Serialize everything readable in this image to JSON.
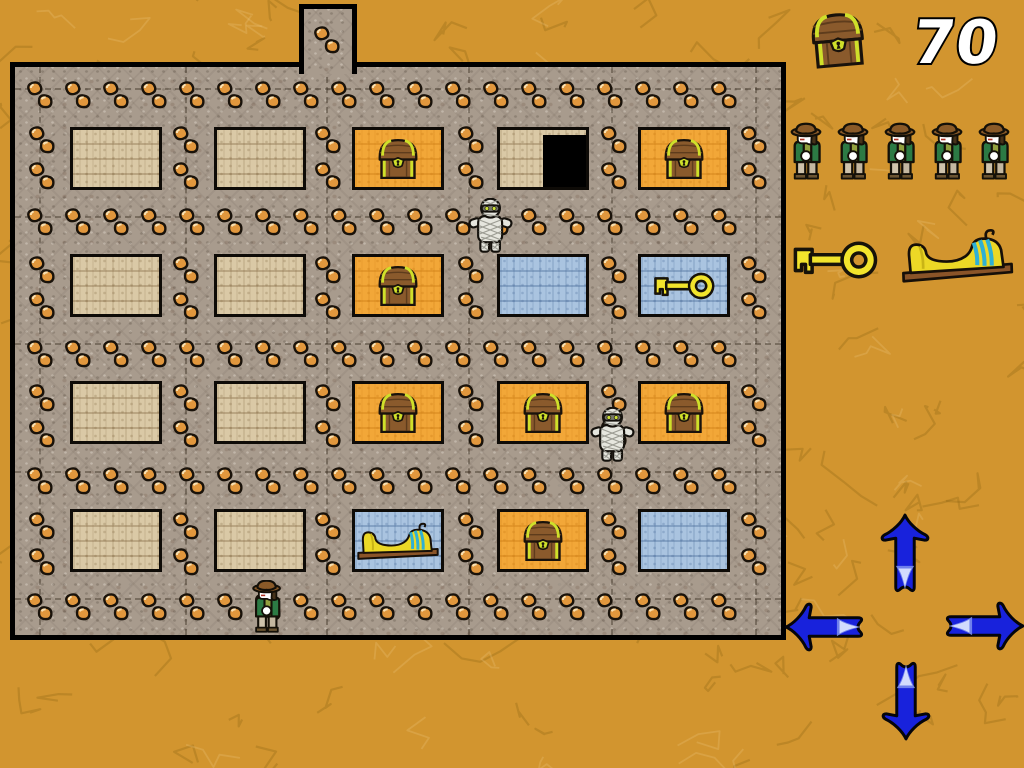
{
  "hud": {
    "score": {
      "value": "70",
      "icon": "treasure-chest-icon"
    },
    "lives": {
      "count": 5,
      "icon": "explorer-icon"
    },
    "goal_items": [
      {
        "icon": "key-icon"
      },
      {
        "icon": "sarcophagus-icon"
      }
    ]
  },
  "controls": {
    "buttons": [
      {
        "direction": "up",
        "icon": "up-arrow-icon"
      },
      {
        "direction": "left",
        "icon": "left-arrow-icon"
      },
      {
        "direction": "right",
        "icon": "right-arrow-icon"
      },
      {
        "direction": "down",
        "icon": "down-arrow-icon"
      }
    ]
  },
  "board": {
    "rows": 4,
    "cols": 5,
    "cells": [
      {
        "row": 0,
        "col": 0,
        "type": "tan",
        "item": null
      },
      {
        "row": 0,
        "col": 1,
        "type": "tan",
        "item": null
      },
      {
        "row": 0,
        "col": 2,
        "type": "orange",
        "item": "chest"
      },
      {
        "row": 0,
        "col": 3,
        "type": "tan",
        "item": "door"
      },
      {
        "row": 0,
        "col": 4,
        "type": "orange",
        "item": "chest"
      },
      {
        "row": 1,
        "col": 0,
        "type": "tan",
        "item": null
      },
      {
        "row": 1,
        "col": 1,
        "type": "tan",
        "item": null
      },
      {
        "row": 1,
        "col": 2,
        "type": "orange",
        "item": "chest"
      },
      {
        "row": 1,
        "col": 3,
        "type": "blue",
        "item": null
      },
      {
        "row": 1,
        "col": 4,
        "type": "blue",
        "item": "key"
      },
      {
        "row": 2,
        "col": 0,
        "type": "tan",
        "item": null
      },
      {
        "row": 2,
        "col": 1,
        "type": "tan",
        "item": null
      },
      {
        "row": 2,
        "col": 2,
        "type": "orange",
        "item": "chest"
      },
      {
        "row": 2,
        "col": 3,
        "type": "orange",
        "item": "chest"
      },
      {
        "row": 2,
        "col": 4,
        "type": "orange",
        "item": "chest"
      },
      {
        "row": 3,
        "col": 0,
        "type": "tan",
        "item": null
      },
      {
        "row": 3,
        "col": 1,
        "type": "tan",
        "item": null
      },
      {
        "row": 3,
        "col": 2,
        "type": "blue",
        "item": "sarcophagus"
      },
      {
        "row": 3,
        "col": 3,
        "type": "orange",
        "item": "chest"
      },
      {
        "row": 3,
        "col": 4,
        "type": "blue",
        "item": null
      }
    ],
    "sprites": [
      {
        "type": "mummy",
        "x": 452,
        "y": 131
      },
      {
        "type": "mummy",
        "x": 574,
        "y": 340
      },
      {
        "type": "explorer",
        "x": 230,
        "y": 513
      }
    ]
  },
  "colors": {
    "background": "#d2952f",
    "floor_stone": "#a89b8d",
    "wall_outline": "#000000",
    "cell_tan": "#dac9a6",
    "cell_orange": "#f2a738",
    "cell_blue": "#aac4e0",
    "arrow_blue": "#1822dc",
    "pebble_orange": "#e1973d",
    "gold_item": "#f2e42c",
    "score_text": "#ffffff"
  }
}
